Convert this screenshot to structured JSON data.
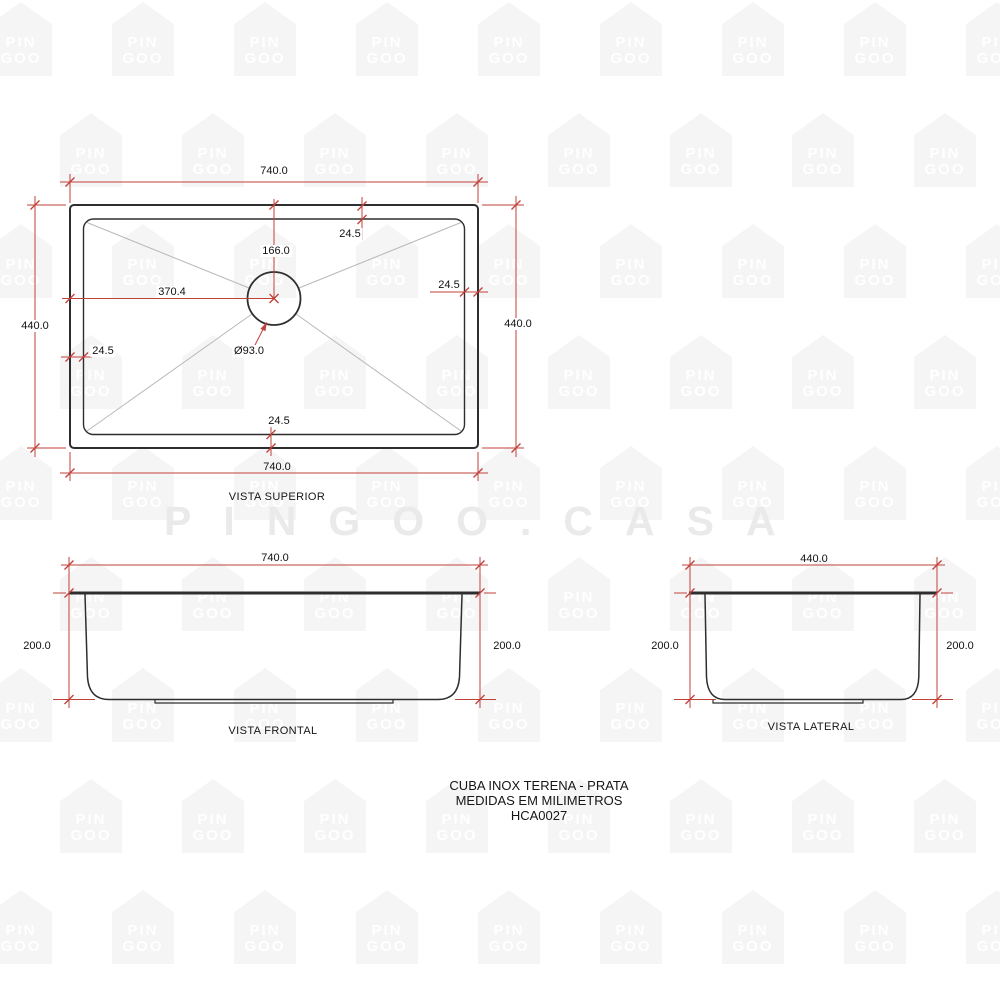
{
  "watermark": {
    "tile_line1": "PIN",
    "tile_line2": "GOO",
    "center_text": "PINGOO.CASA"
  },
  "colors": {
    "dimension": "#c2403a",
    "outline": "#2e2e2e",
    "diagonal": "#b8b8b8",
    "house": "#f5f5f5",
    "house_text": "#ffffff",
    "big_watermark": "#eaeaea"
  },
  "views": {
    "top": {
      "label": "VISTA SUPERIOR",
      "dims": {
        "width_top": "740.0",
        "width_bottom": "740.0",
        "height_left": "440.0",
        "height_right": "440.0",
        "center_from_top": "166.0",
        "center_from_left": "370.4",
        "flange_top": "24.5",
        "flange_right": "24.5",
        "flange_left": "24.5",
        "flange_bottom": "24.5",
        "drain_diameter": "Ø93.0"
      }
    },
    "front": {
      "label": "VISTA FRONTAL",
      "dims": {
        "width": "740.0",
        "height_left": "200.0",
        "height_right": "200.0"
      }
    },
    "side": {
      "label": "VISTA LATERAL",
      "dims": {
        "width": "440.0",
        "height_left": "200.0",
        "height_right": "200.0"
      }
    }
  },
  "footer": {
    "line1": "CUBA INOX TERENA - PRATA",
    "line2": "MEDIDAS EM MILIMETROS",
    "line3": "HCA0027"
  }
}
